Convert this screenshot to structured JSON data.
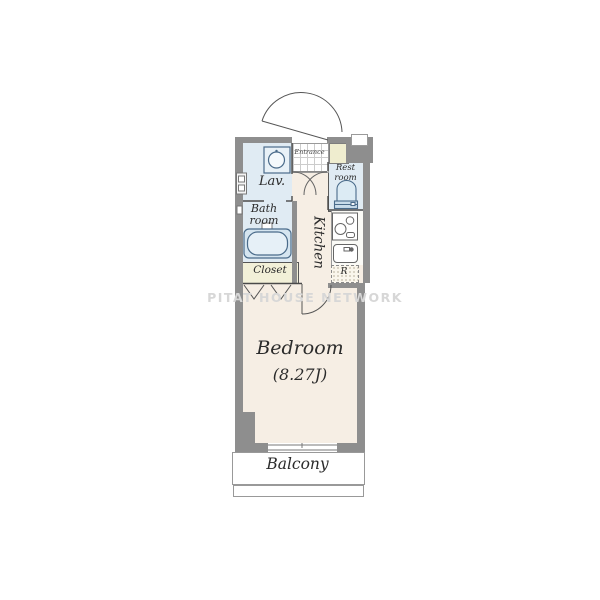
{
  "floorplan": {
    "watermark": "PITAT HOUSE NETWORK",
    "rooms": {
      "bedroom": "Bedroom",
      "bedroom_size": "(8.27J)",
      "kitchen": "Kitchen",
      "lavatory": "Lav.",
      "bathroom": "Bath room",
      "restroom": "Rest room",
      "closet": "Closet",
      "entrance": "Entrance",
      "balcony": "Balcony",
      "refrigerator": "R"
    },
    "colors": {
      "wall": "#8e8e8e",
      "floor": "#f6eee4",
      "wet_area": "#e0ebf3",
      "closet_fill": "#f2f0d8",
      "cabinet_fill": "#efedcf",
      "fixture_outline": "#4a6b8a",
      "watermark": "#d7d7d7"
    }
  }
}
